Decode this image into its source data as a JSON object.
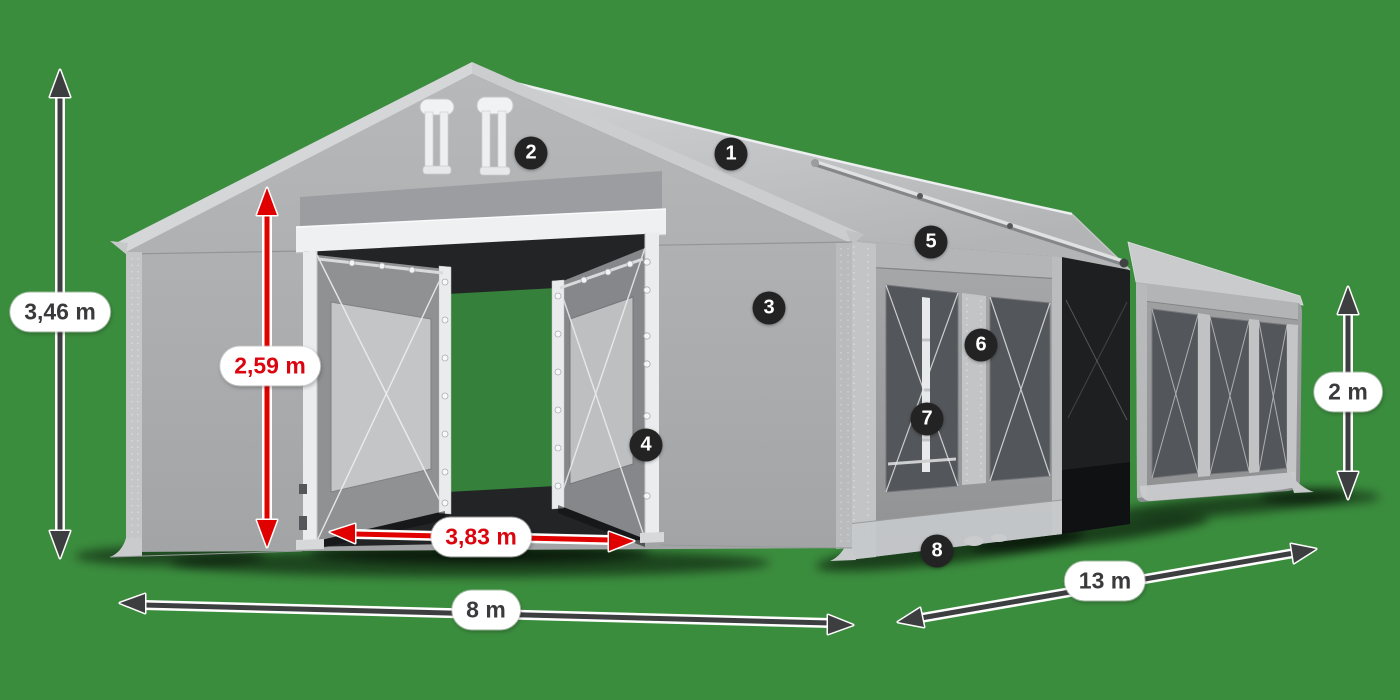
{
  "scene": {
    "background_color": "#3b8d3e"
  },
  "dimensions": {
    "total_height": {
      "label": "3,46 m",
      "color": "#3a3a3c"
    },
    "entrance_height": {
      "label": "2,59 m",
      "color": "#db0510"
    },
    "entrance_width": {
      "label": "3,83 m",
      "color": "#db0510"
    },
    "width": {
      "label": "8 m",
      "color": "#3a3a3c"
    },
    "length": {
      "label": "13 m",
      "color": "#3a3a3c"
    },
    "side_height": {
      "label": "2 m",
      "color": "#3a3a3c"
    }
  },
  "callouts": [
    {
      "number": "1"
    },
    {
      "number": "2"
    },
    {
      "number": "3"
    },
    {
      "number": "4"
    },
    {
      "number": "5"
    },
    {
      "number": "6"
    },
    {
      "number": "7"
    },
    {
      "number": "8"
    }
  ],
  "colors": {
    "background_green": "#3b8d3e",
    "arrow_dark": "#3d3e40",
    "arrow_red": "#e00000",
    "red_text": "#db0510",
    "dark_text": "#3a3a3c",
    "badge_background": "#232323",
    "tent_gray_light": "#cfd1d3",
    "tent_gray_mid": "#a5a7a9",
    "tent_gray_dark": "#53565a"
  }
}
